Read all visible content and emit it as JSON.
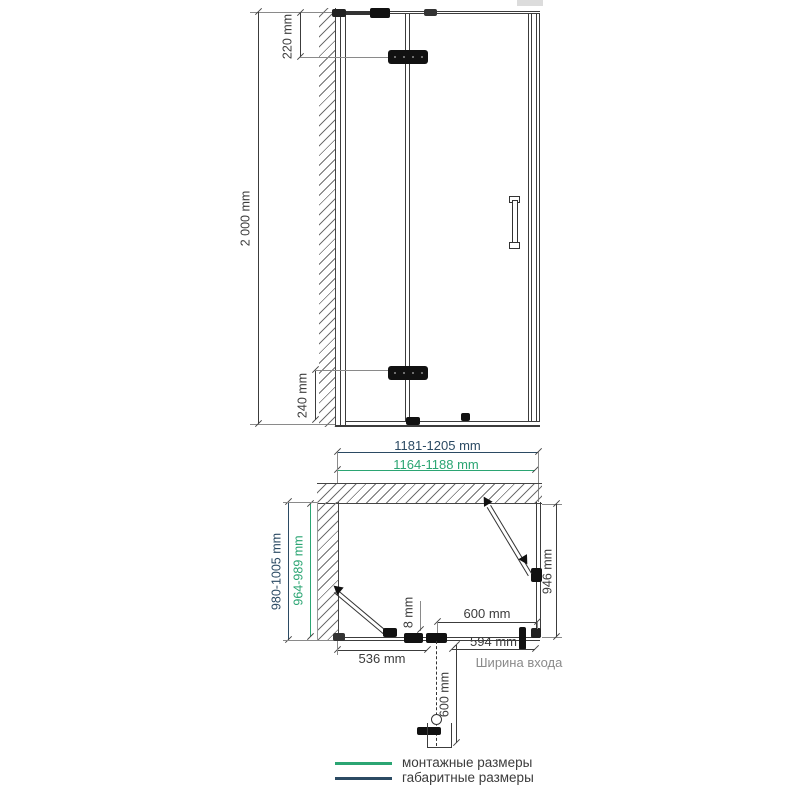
{
  "front_view": {
    "overall_height": "2 000 mm",
    "top_hinge_offset": "220 mm",
    "bottom_hinge_offset": "240 mm"
  },
  "plan_view": {
    "overall_width": "1181-1205 mm",
    "mounting_width": "1164-1188 mm",
    "overall_depth": "980-1005 mm",
    "mounting_depth": "964-989 mm",
    "side_panel_depth": "946 mm",
    "door_width": "600 mm",
    "glass_thickness": "8 mm",
    "fixed_panel_width": "536 mm",
    "entrance_width": "594 mm",
    "entrance_width_label": "Ширина входа",
    "door_opening_clearance": "600 mm"
  },
  "legend": {
    "items": [
      {
        "label": "монтажные размеры",
        "color": "#2ba573"
      },
      {
        "label": "габаритные размеры",
        "color": "#2b4a63"
      }
    ]
  },
  "colors": {
    "mounting_green": "#2ba573",
    "overall_navy": "#2b4a63",
    "line": "#3c3c3c"
  }
}
